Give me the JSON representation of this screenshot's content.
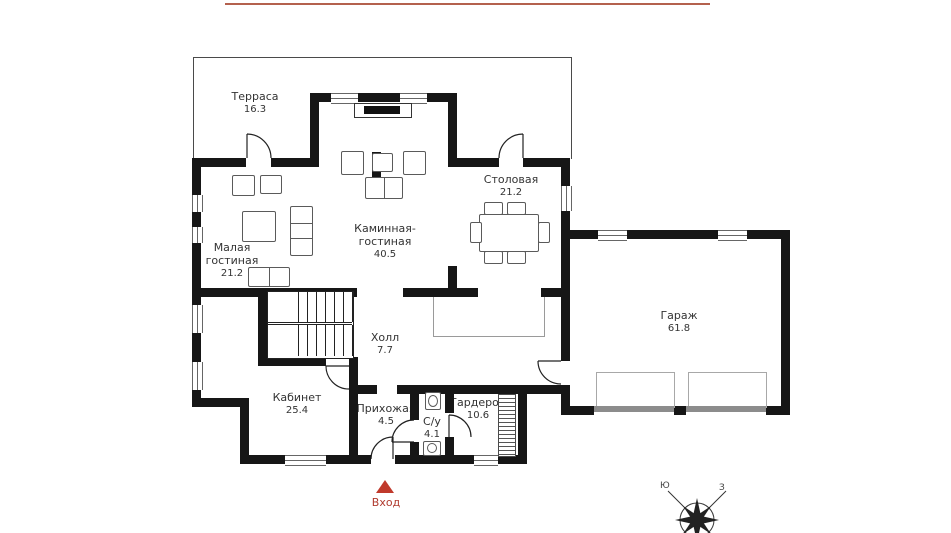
{
  "rooms": {
    "terrace": {
      "name": "Терраса",
      "area": "16.3"
    },
    "small_living": {
      "line1": "Малая",
      "line2": "гостиная",
      "area": "21.2"
    },
    "fireplace_living": {
      "line1": "Каминная-",
      "line2": "гостиная",
      "area": "40.5"
    },
    "dining": {
      "name": "Столовая",
      "area": "21.2"
    },
    "kitchen": {
      "name": "Кухня",
      "area": "11.5"
    },
    "hall": {
      "name": "Холл",
      "area": "7.7"
    },
    "office": {
      "name": "Кабинет",
      "area": "25.4"
    },
    "entry_hall": {
      "name": "Прихожая",
      "area": "4.5"
    },
    "bathroom": {
      "name": "С/у",
      "area": "4.1"
    },
    "wardrobe": {
      "name": "Гардероб",
      "area": "10.6"
    },
    "garage": {
      "name": "Гараж",
      "area": "61.8"
    }
  },
  "entrance": {
    "label": "Вход",
    "marker_color": "#c0392b",
    "text_color": "#b03a2e"
  },
  "compass": {
    "south": "Ю",
    "west": "З"
  },
  "decor": {
    "topline_color": "#b4614e",
    "wall_color": "#161616"
  }
}
